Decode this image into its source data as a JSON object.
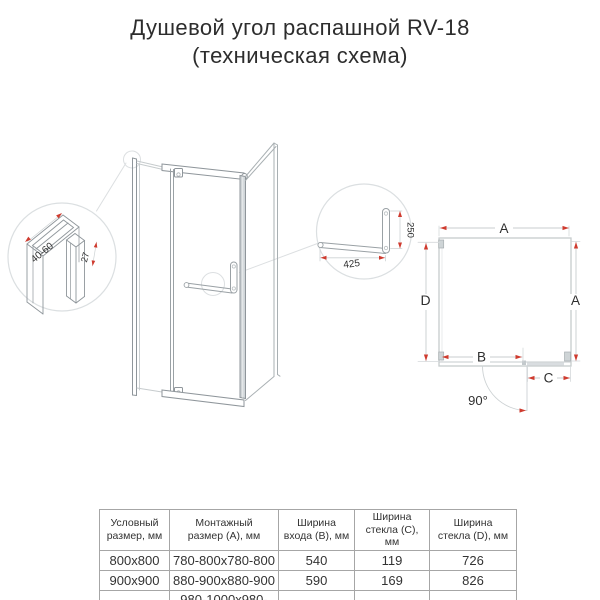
{
  "title": {
    "line1": "Душевой угол распашной RV-18",
    "line2": "(техническая схема)"
  },
  "diagram": {
    "profile_detail": {
      "width_range": "40-60",
      "depth": "27"
    },
    "handle_detail": {
      "bar_length": "425",
      "handle_height": "250"
    },
    "plan": {
      "dim_top": "A",
      "dim_left": "D",
      "dim_right": "A",
      "dim_entrance": "B",
      "dim_glass": "C",
      "door_angle": "90°"
    }
  },
  "table": {
    "headers": [
      "Условный\nразмер, мм",
      "Монтажный\nразмер (A), мм",
      "Ширина\nвхода (B), мм",
      "Ширина\nстекла (C), мм",
      "Ширина\nстекла (D), мм"
    ],
    "rows": [
      [
        "800x800",
        "780-800x780-800",
        "540",
        "119",
        "726"
      ],
      [
        "900x900",
        "880-900x880-900",
        "590",
        "169",
        "826"
      ],
      [
        "1000x1000",
        "980-1000x980-1000",
        "590",
        "269",
        "926"
      ]
    ]
  },
  "colors": {
    "accent_red": "#cf3b2f",
    "line_light": "#c6cbcd",
    "line_frame": "#8f969b",
    "text_dark": "#2f2f2f"
  }
}
